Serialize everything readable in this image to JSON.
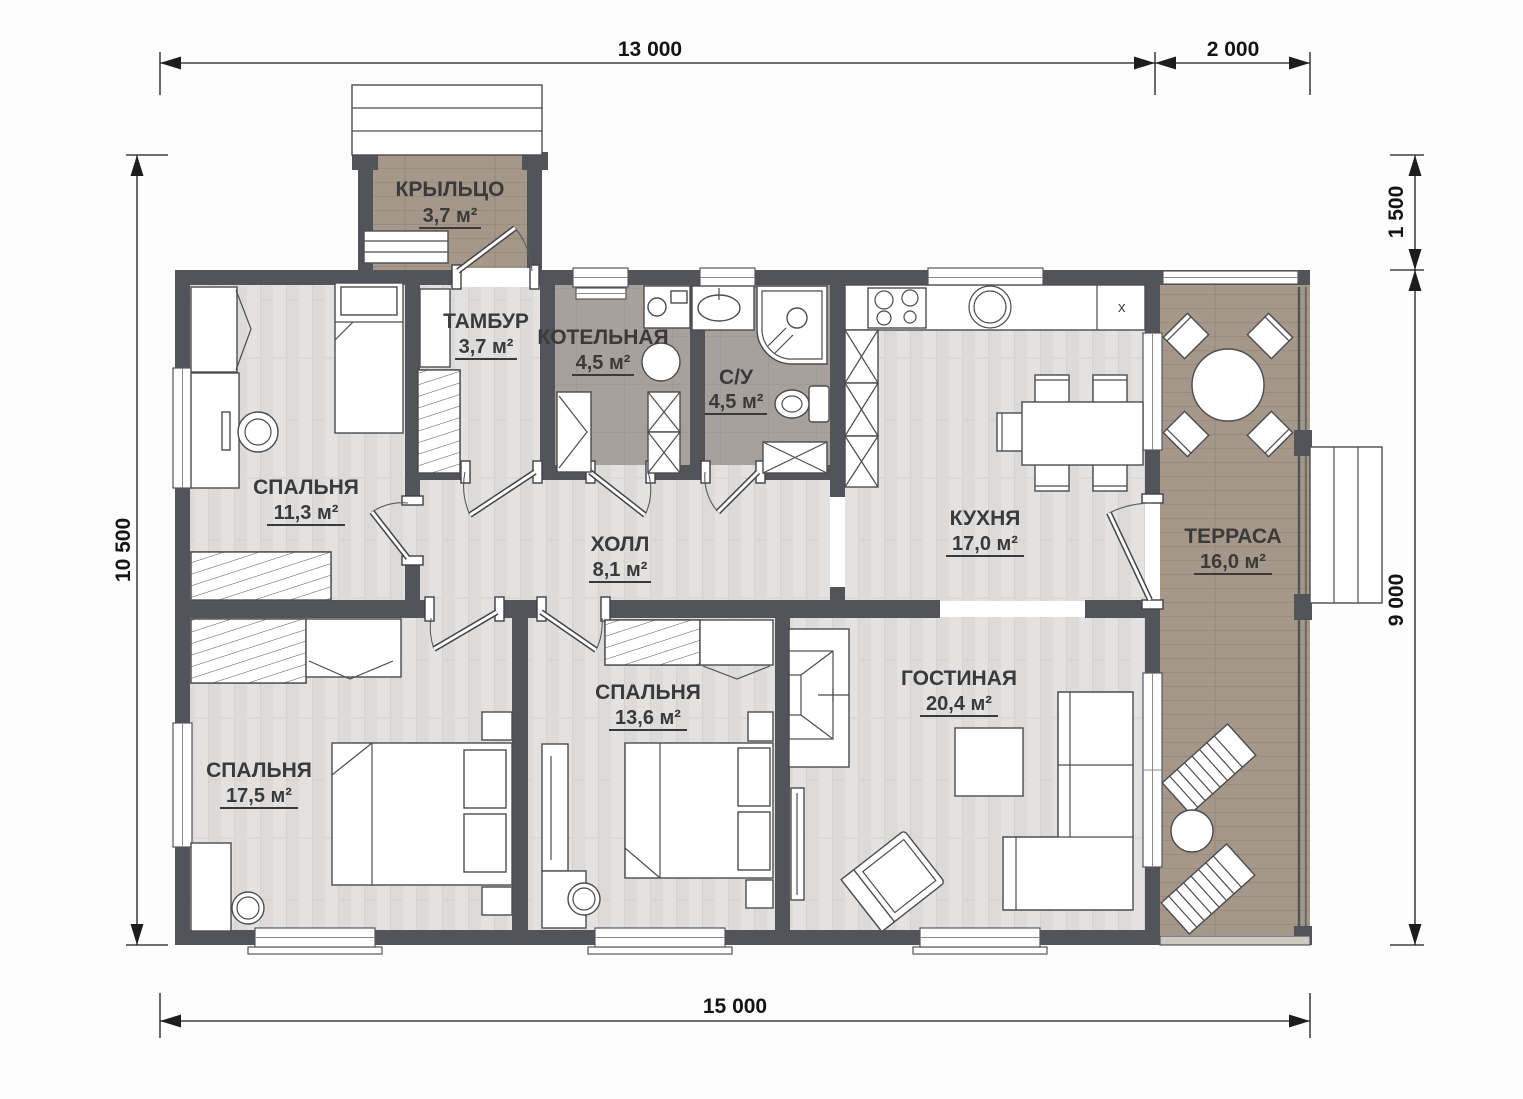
{
  "plan": {
    "type": "single-storey house floor plan"
  },
  "dimensions": {
    "top_main": "13 000",
    "top_secondary": "2 000",
    "bottom": "15 000",
    "left": "10 500",
    "right_top": "1 500",
    "right_main": "9 000"
  },
  "rooms": {
    "porch": {
      "name": "КРЫЛЬЦО",
      "area": "3,7 м²"
    },
    "vestibule": {
      "name": "ТАМБУР",
      "area": "3,7 м²"
    },
    "boiler": {
      "name": "КОТЕЛЬНАЯ",
      "area": "4,5 м²"
    },
    "bathroom": {
      "name": "С/У",
      "area": "4,5 м²"
    },
    "kitchen": {
      "name": "КУХНЯ",
      "area": "17,0 м²",
      "counter_mark": "x"
    },
    "terrace": {
      "name": "ТЕРРАСА",
      "area": "16,0 м²"
    },
    "bedroom_top": {
      "name": "СПАЛЬНЯ",
      "area": "11,3 м²"
    },
    "hall": {
      "name": "ХОЛЛ",
      "area": "8,1 м²"
    },
    "bedroom_left": {
      "name": "СПАЛЬНЯ",
      "area": "17,5 м²"
    },
    "bedroom_mid": {
      "name": "СПАЛЬНЯ",
      "area": "13,6 м²"
    },
    "living": {
      "name": "ГОСТИНАЯ",
      "area": "20,4 м²"
    }
  },
  "colors": {
    "wall": "#53545a",
    "floor_light": "#e3e2e1",
    "floor_dark": "#a6a19c",
    "wood": "#a5988b",
    "line": "#4c4c4c",
    "text": "#3a3a3a"
  }
}
